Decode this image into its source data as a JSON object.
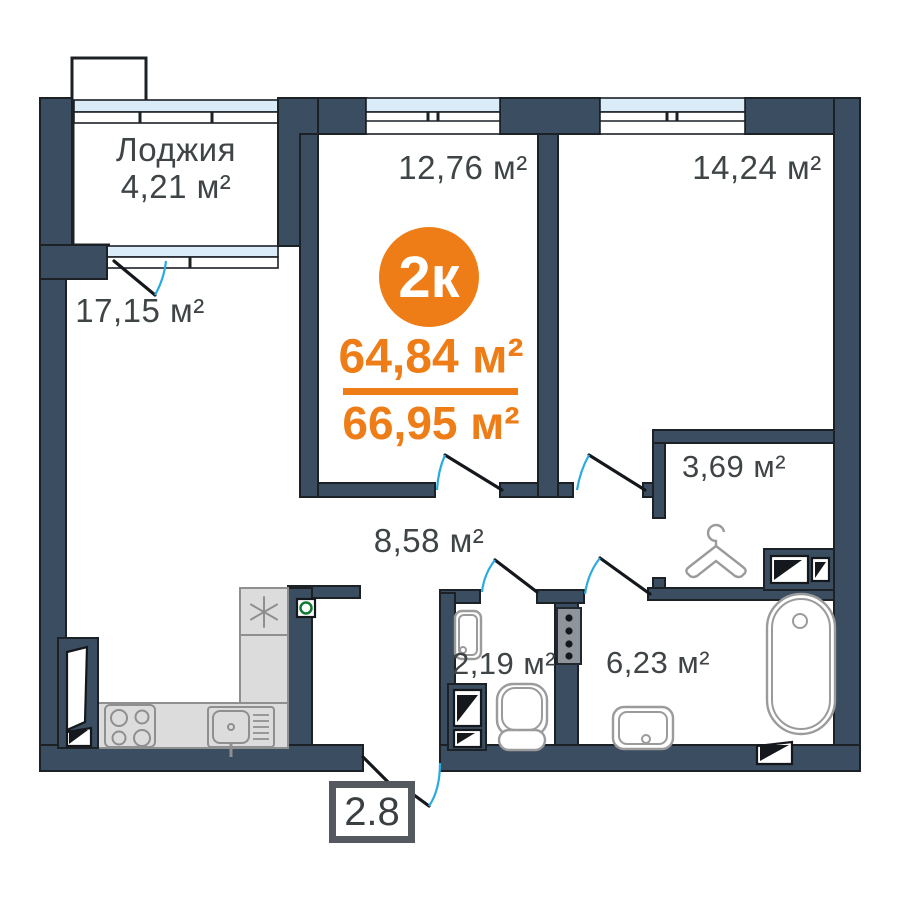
{
  "plan": {
    "badge": {
      "label": "2к"
    },
    "areas": {
      "primary": "64,84 м²",
      "secondary": "66,95 м²"
    },
    "entrance_tag": "2.8",
    "rooms": {
      "loggia": {
        "name": "Лоджия",
        "area": "4,21 м²"
      },
      "living_room": {
        "area": "17,15 м²"
      },
      "kitchen_living": {
        "area": "12,76 м²"
      },
      "bedroom": {
        "area": "14,24 м²"
      },
      "wardrobe": {
        "area": "3,69 м²"
      },
      "hallway": {
        "area": "8,58 м²"
      },
      "wc": {
        "area": "2,19 м²"
      },
      "bathroom": {
        "area": "6,23 м²"
      }
    },
    "colors": {
      "wall": "#3b4d60",
      "accent": "#ee7d17",
      "glazing": "#d9ecf8",
      "door_arc": "#29abe2",
      "label": "#3f4446",
      "fixture": "#9b9b9b",
      "counter_fill": "#dcdcdc",
      "counter_stroke": "#8f8f8f",
      "outlet_green": "#0e7a33",
      "tag_border": "#53595e",
      "outline": "#1c2126"
    }
  }
}
